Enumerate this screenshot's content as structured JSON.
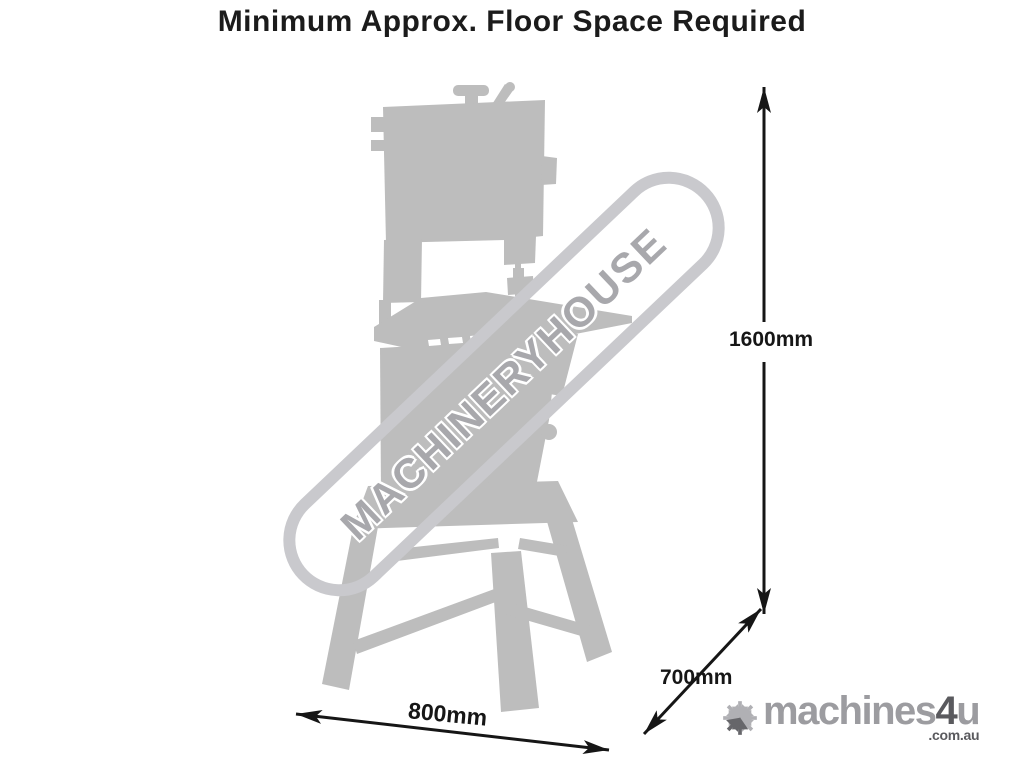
{
  "title": "Minimum Approx. Floor Space Required",
  "diagram": {
    "subject": "bandsaw-on-stand-silhouette",
    "dimensions": {
      "height": {
        "label": "1600mm",
        "value_mm": 1600,
        "orientation": "vertical"
      },
      "depth": {
        "label": "700mm",
        "value_mm": 700,
        "orientation": "diagonal"
      },
      "width": {
        "label": "800mm",
        "value_mm": 800,
        "orientation": "horizontal"
      }
    }
  },
  "watermark": {
    "text": "MACHINERYHOUSE"
  },
  "logo": {
    "icon": "arrow-snowflake-icon",
    "part_machines": "machines",
    "part_4": "4",
    "part_u": "u",
    "domain_suffix": ".com.au"
  },
  "colors": {
    "background": "#ffffff",
    "title_text": "#1b1b1b",
    "silhouette_gray": "#bdbdbd",
    "watermark_gray": "#a8a8ac",
    "watermark_band": "#c9c9cd",
    "dimension_black": "#161616",
    "logo_light_gray": "#9c9ca0",
    "logo_dark_gray": "#5a5a5e"
  }
}
